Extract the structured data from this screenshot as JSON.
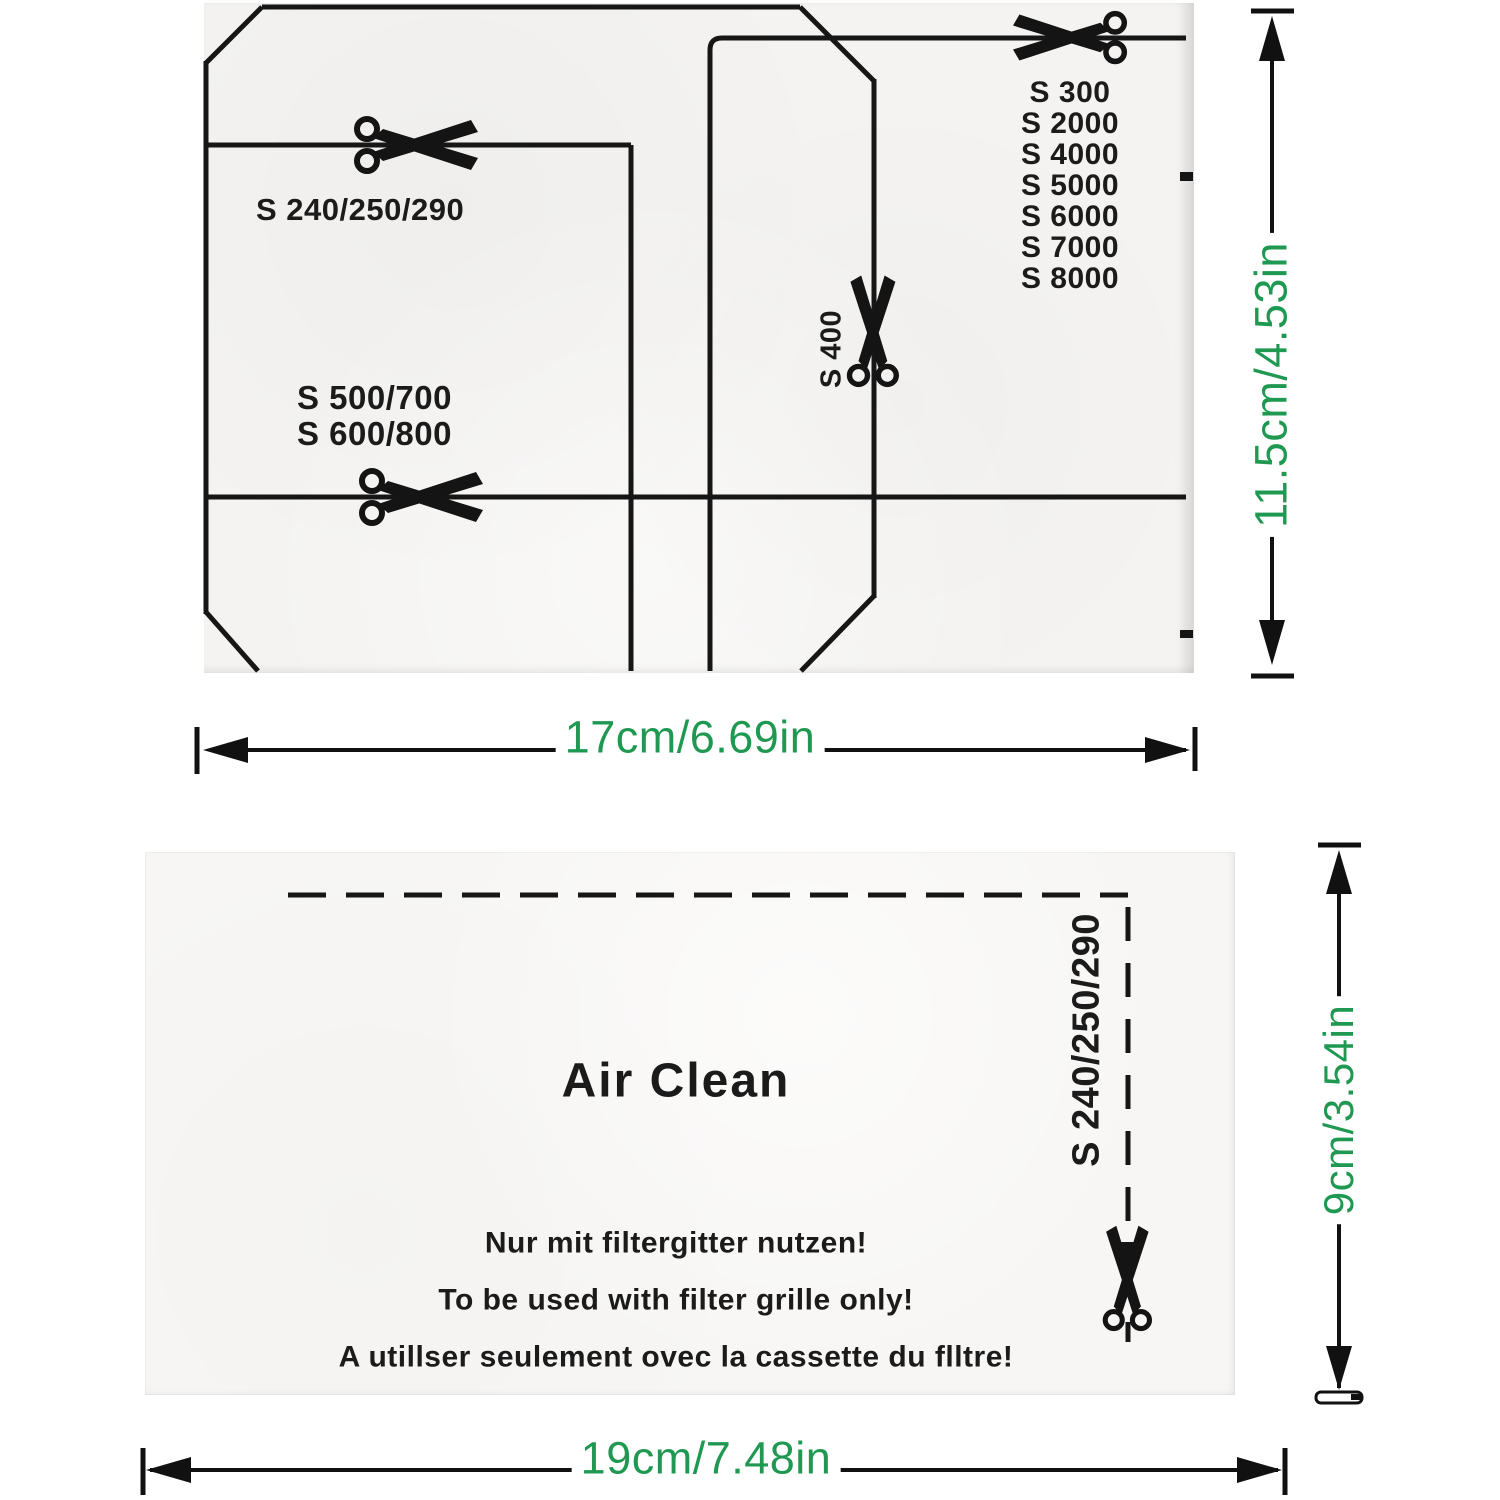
{
  "colors": {
    "dim_green": "#1f9951",
    "ink": "#1b1b1b"
  },
  "top_filter": {
    "cut_label_top": "S 240/250/290",
    "cut_label_mid_1": "S 500/700",
    "cut_label_mid_2": "S 600/800",
    "vertical_label": "S 400",
    "model_list": [
      "S 300",
      "S 2000",
      "S 4000",
      "S 5000",
      "S 6000",
      "S 7000",
      "S 8000"
    ],
    "width_dimension": "17cm/6.69in",
    "height_dimension": "11.5cm/4.53in"
  },
  "bottom_filter": {
    "title": "Air Clean",
    "notice_lines": [
      "Nur mit filtergitter nutzen!",
      "To be used with filter grille only!",
      "A utillser seulement ovec la cassette du flltre!"
    ],
    "cut_label": "S 240/250/290",
    "width_dimension": "19cm/7.48in",
    "height_dimension": "9cm/3.54in"
  }
}
